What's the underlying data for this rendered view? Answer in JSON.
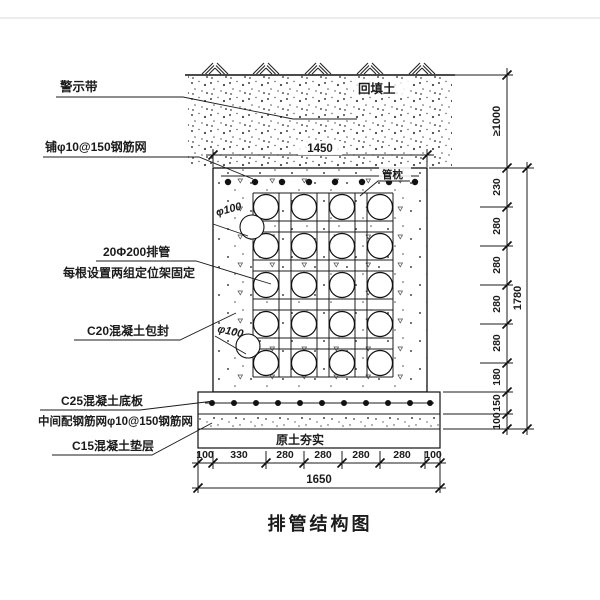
{
  "title": "排管结构图",
  "annotations": {
    "warning_tape": "警示带",
    "top_mesh": "铺φ10@150钢筋网",
    "pipe_count": "20Φ200排管",
    "pipe_fixing": "每根设置两组定位架固定",
    "encasement": "C20混凝土包封",
    "base_slab": "C25混凝土底板",
    "slab_mesh": "中间配钢筋网φ10@150钢筋网",
    "cushion": "C15混凝土垫层",
    "backfill_soil": "回填土",
    "pipe_pillow": "管枕",
    "compacted_soil": "原土夯实",
    "pipe_dia_top": "φ100",
    "pipe_dia_bottom": "φ100"
  },
  "dimensions": {
    "top_width": "1450",
    "bottom_segments": [
      "100",
      "330",
      "280",
      "280",
      "280",
      "280",
      "100"
    ],
    "bottom_total": "1650",
    "cover_depth": "≥1000",
    "right_segments": [
      "230",
      "280",
      "280",
      "280",
      "280",
      "180",
      "150",
      "100"
    ],
    "right_total": "1780"
  }
}
